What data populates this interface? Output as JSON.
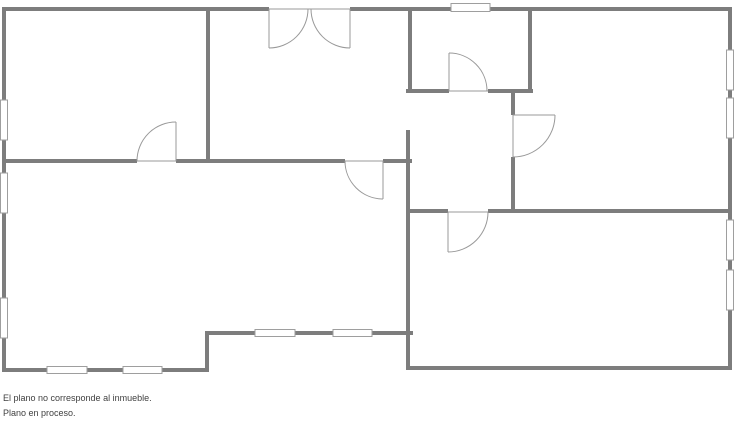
{
  "disclaimer": {
    "line1": "El plano no corresponde al inmueble.",
    "line2": "Plano en proceso."
  },
  "colors": {
    "background": "#ffffff",
    "wall": "#7d7d7d",
    "thin_line": "#999999",
    "window_fill": "#ffffff",
    "window_border": "#9e9e9e",
    "text": "#3f3f3f"
  },
  "floor_plan": {
    "canvas": {
      "width": 736,
      "height": 424
    },
    "walls": [
      {
        "name": "top-wall-left-segment",
        "x": 2,
        "y": 7,
        "w": 267,
        "h": 4
      },
      {
        "name": "top-wall-middle-segment",
        "x": 350,
        "y": 7,
        "w": 101,
        "h": 4
      },
      {
        "name": "top-wall-right-segment",
        "x": 490,
        "y": 7,
        "w": 242,
        "h": 4
      },
      {
        "name": "left-exterior-wall",
        "x": 2,
        "y": 7,
        "w": 4,
        "h": 365
      },
      {
        "name": "right-exterior-wall",
        "x": 728,
        "y": 7,
        "w": 4,
        "h": 363
      },
      {
        "name": "bottom-wall-left",
        "x": 2,
        "y": 368,
        "w": 207,
        "h": 4
      },
      {
        "name": "step-wall-vertical",
        "x": 205,
        "y": 331,
        "w": 4,
        "h": 41
      },
      {
        "name": "step-wall-horizontal",
        "x": 205,
        "y": 331,
        "w": 208,
        "h": 4
      },
      {
        "name": "bottom-wall-right",
        "x": 406,
        "y": 366,
        "w": 326,
        "h": 4
      },
      {
        "name": "divider-topleft-topmid",
        "x": 206,
        "y": 7,
        "w": 4,
        "h": 156
      },
      {
        "name": "mid-horizontal-wall-a",
        "x": 2,
        "y": 159,
        "w": 135,
        "h": 4
      },
      {
        "name": "mid-horizontal-wall-b",
        "x": 176,
        "y": 159,
        "w": 169,
        "h": 4
      },
      {
        "name": "mid-horizontal-wall-c",
        "x": 383,
        "y": 159,
        "w": 29,
        "h": 4
      },
      {
        "name": "small-room-left-wall",
        "x": 408,
        "y": 7,
        "w": 4,
        "h": 85
      },
      {
        "name": "small-room-bottom-wall-a",
        "x": 406,
        "y": 89,
        "w": 43,
        "h": 4
      },
      {
        "name": "small-room-bottom-wall-b",
        "x": 488,
        "y": 89,
        "w": 45,
        "h": 4
      },
      {
        "name": "central-vertical-wall",
        "x": 406,
        "y": 130,
        "w": 4,
        "h": 240
      },
      {
        "name": "small-room-right-wall",
        "x": 528,
        "y": 7,
        "w": 4,
        "h": 86
      },
      {
        "name": "right-room-left-wall-a",
        "x": 511,
        "y": 89,
        "w": 4,
        "h": 26
      },
      {
        "name": "right-room-left-wall-b",
        "x": 511,
        "y": 157,
        "w": 4,
        "h": 55
      },
      {
        "name": "bottomright-room-top-wall-a",
        "x": 406,
        "y": 209,
        "w": 42,
        "h": 4
      },
      {
        "name": "bottomright-room-top-wall-b",
        "x": 488,
        "y": 209,
        "w": 244,
        "h": 4
      }
    ],
    "windows": [
      {
        "name": "window-top",
        "x": 451,
        "y": 3.5,
        "w": 39,
        "h": 8
      },
      {
        "name": "window-left-1",
        "x": 0.5,
        "y": 100,
        "w": 7,
        "h": 40
      },
      {
        "name": "window-left-2",
        "x": 0.5,
        "y": 173,
        "w": 7,
        "h": 40
      },
      {
        "name": "window-left-3",
        "x": 0.5,
        "y": 298,
        "w": 7,
        "h": 40
      },
      {
        "name": "window-right-1",
        "x": 726.5,
        "y": 50,
        "w": 7,
        "h": 40
      },
      {
        "name": "window-right-2",
        "x": 726.5,
        "y": 98,
        "w": 7,
        "h": 40
      },
      {
        "name": "window-right-3",
        "x": 726.5,
        "y": 220,
        "w": 7,
        "h": 40
      },
      {
        "name": "window-right-4",
        "x": 726.5,
        "y": 270,
        "w": 7,
        "h": 40
      },
      {
        "name": "window-bottom-1",
        "x": 47,
        "y": 366.5,
        "w": 40,
        "h": 7
      },
      {
        "name": "window-bottom-2",
        "x": 123,
        "y": 366.5,
        "w": 39,
        "h": 7
      },
      {
        "name": "window-step-1",
        "x": 255,
        "y": 329.5,
        "w": 40,
        "h": 7
      },
      {
        "name": "window-step-2",
        "x": 333,
        "y": 329.5,
        "w": 39,
        "h": 7
      }
    ],
    "door_lines": [
      {
        "name": "double-door-threshold",
        "x1": 269,
        "y1": 9,
        "x2": 350,
        "y2": 9
      },
      {
        "name": "double-door-left-leaf",
        "x1": 269,
        "y1": 9,
        "x2": 269,
        "y2": 48
      },
      {
        "name": "double-door-right-leaf",
        "x1": 350,
        "y1": 9,
        "x2": 350,
        "y2": 48
      },
      {
        "name": "door-topleft-threshold",
        "x1": 137,
        "y1": 161,
        "x2": 176,
        "y2": 161
      },
      {
        "name": "door-topleft-leaf",
        "x1": 176,
        "y1": 122,
        "x2": 176,
        "y2": 161
      },
      {
        "name": "door-living-threshold",
        "x1": 345,
        "y1": 161,
        "x2": 383,
        "y2": 161
      },
      {
        "name": "door-living-leaf",
        "x1": 383,
        "y1": 161,
        "x2": 383,
        "y2": 199
      },
      {
        "name": "door-smallroom-threshold",
        "x1": 449,
        "y1": 91,
        "x2": 488,
        "y2": 91
      },
      {
        "name": "door-smallroom-leaf",
        "x1": 449,
        "y1": 53,
        "x2": 449,
        "y2": 91
      },
      {
        "name": "door-rightroom-threshold",
        "x1": 513,
        "y1": 115,
        "x2": 513,
        "y2": 157
      },
      {
        "name": "door-rightroom-leaf",
        "x1": 513,
        "y1": 115,
        "x2": 555,
        "y2": 115
      },
      {
        "name": "door-bottomright-threshold",
        "x1": 448,
        "y1": 212,
        "x2": 488,
        "y2": 212
      },
      {
        "name": "door-bottomright-leaf",
        "x1": 448,
        "y1": 212,
        "x2": 448,
        "y2": 252
      }
    ],
    "door_arcs": [
      {
        "name": "double-door-left-arc",
        "x1": 269,
        "y1": 48,
        "x2": 308,
        "y2": 9,
        "r": 39,
        "sweep": 0
      },
      {
        "name": "double-door-right-arc",
        "x1": 350,
        "y1": 48,
        "x2": 311,
        "y2": 9,
        "r": 39,
        "sweep": 1
      },
      {
        "name": "door-topleft-arc",
        "x1": 137,
        "y1": 161,
        "x2": 176,
        "y2": 122,
        "r": 39,
        "sweep": 1
      },
      {
        "name": "door-living-arc",
        "x1": 345,
        "y1": 161,
        "x2": 383,
        "y2": 199,
        "r": 38,
        "sweep": 0
      },
      {
        "name": "door-smallroom-arc",
        "x1": 449,
        "y1": 53,
        "x2": 487,
        "y2": 91,
        "r": 38,
        "sweep": 1
      },
      {
        "name": "door-rightroom-arc",
        "x1": 555,
        "y1": 115,
        "x2": 513,
        "y2": 157,
        "r": 42,
        "sweep": 1
      },
      {
        "name": "door-bottomright-arc",
        "x1": 448,
        "y1": 252,
        "x2": 488,
        "y2": 212,
        "r": 40,
        "sweep": 0
      }
    ]
  }
}
